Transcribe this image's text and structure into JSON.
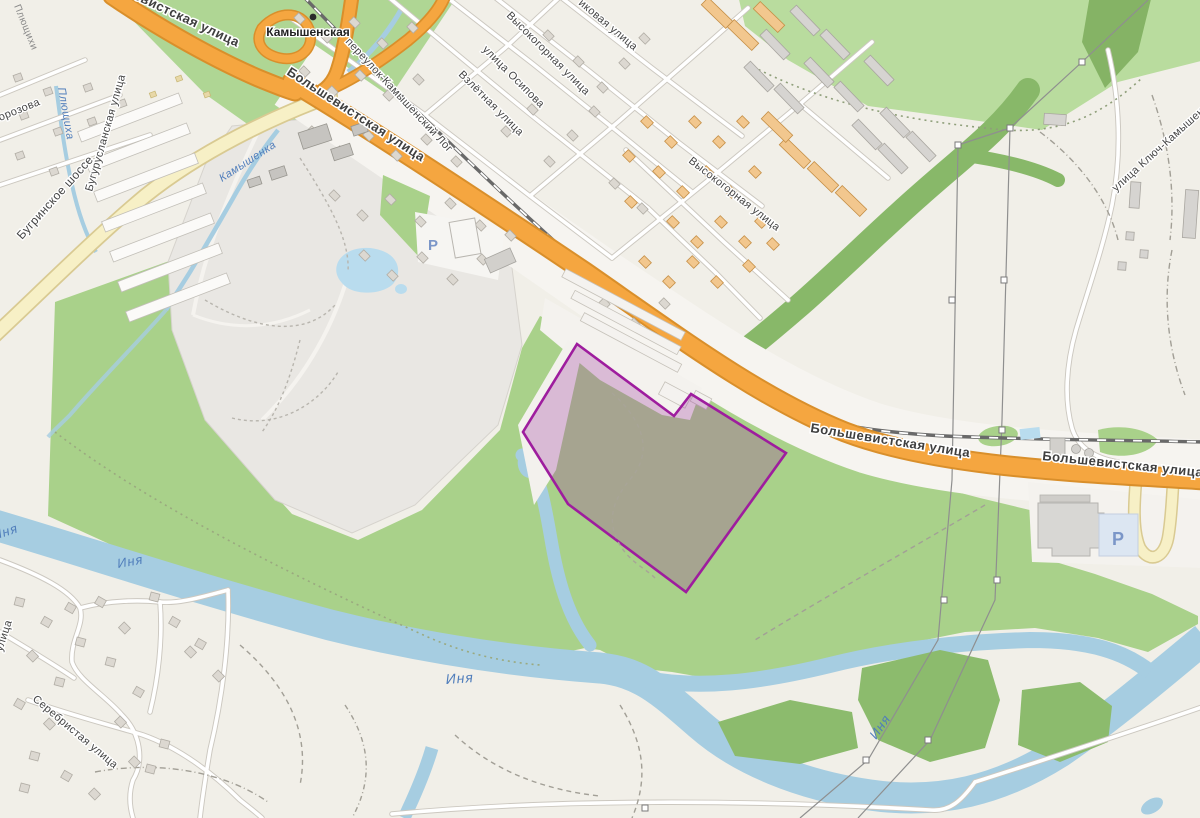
{
  "map": {
    "type": "street-map-with-highlighted-parcel",
    "labels": {
      "bolshevistskaya": "Большевистская улица",
      "bugrinskoye": "Бугринское шоссе",
      "buguruslanskaya": "Бугурусланская улица",
      "morozova": "улица Морозова",
      "plyushchikhi": "Плющихи",
      "plyushchikha": "Плющиха",
      "kamyshenka": "Камышенка",
      "kamyshenskaya_station": "Камышенская",
      "kamyshensky_log": "переулок Камышенский Лог",
      "ikovaya_partial": "иковая улица",
      "vysokogornaya": "Высокогорная улица",
      "osipova": "улица Осипова",
      "vzlyotnaya": "Взлётная улица",
      "klyuch_kamyshenskaya": "улица Ключ-Камышенская",
      "inya": "Иня",
      "serebristaya": "Серебристая улица",
      "ulitsa_partial": "улица",
      "parking": "P"
    },
    "colors": {
      "highlight_outline": "#9e1d9e",
      "highlight_fill": "rgba(160,60,160,0.30)",
      "water": "#a6cde1",
      "road_primary": "#f5a640",
      "road_secondary_yellow": "#f7f0c6",
      "forest_green": "#a9d18a",
      "railway": "#696969",
      "parking_icon": "#7b96c8",
      "base_land": "#f1efe8"
    }
  }
}
